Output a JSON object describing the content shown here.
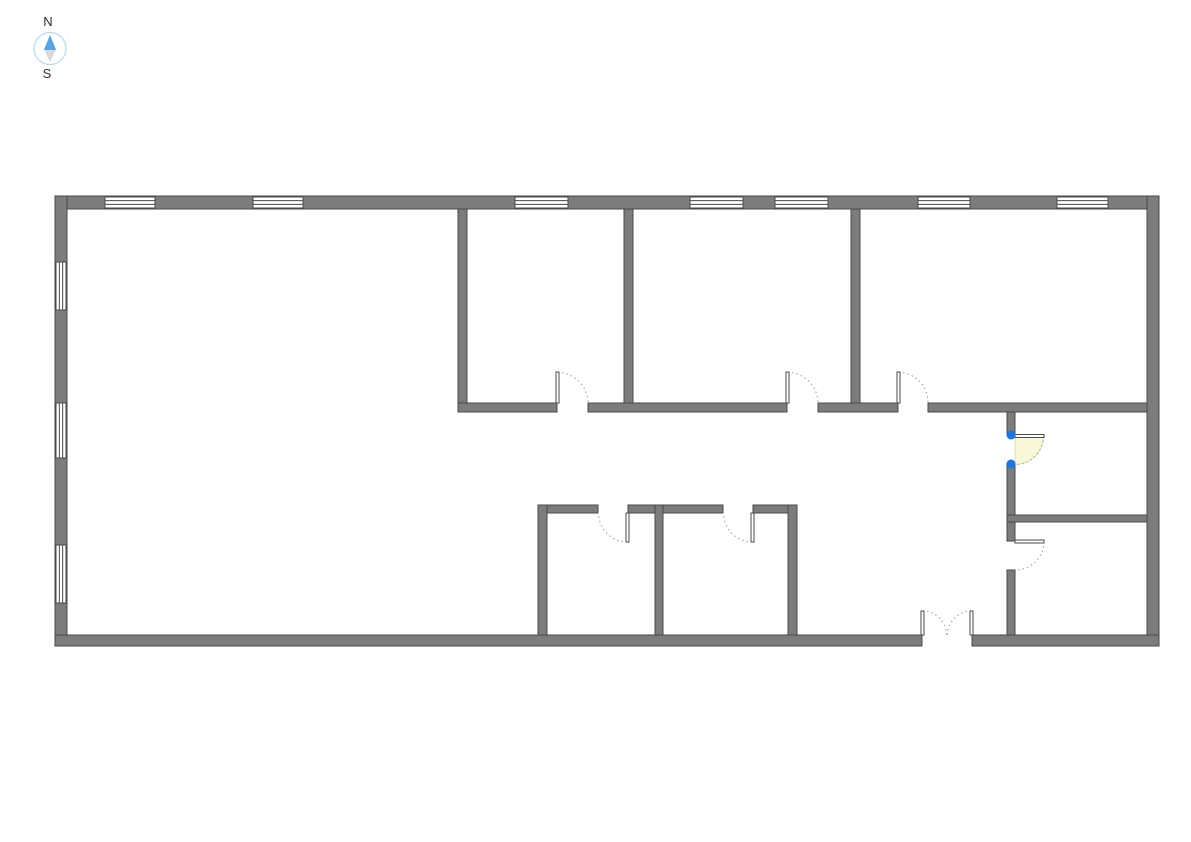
{
  "canvas": {
    "width": 1191,
    "height": 842,
    "background": "#ffffff"
  },
  "compass": {
    "north_label": "N",
    "south_label": "S",
    "ring_color": "#b5d9f2",
    "needle_north_color": "#55a5e5",
    "needle_south_color": "#d8d8d8",
    "label_color": "#2e2e2e"
  },
  "palette": {
    "wall_fill": "#7c7c7c",
    "wall_stroke": "#4a4a4a",
    "window_fill": "#ffffff",
    "window_stroke": "#4a4a4a",
    "door_arc": "#a8a8a8",
    "door_leaf_fill": "#ffffff",
    "door_leaf_stroke": "#4a4a4a",
    "selected_door_fill": "#f8f8d9",
    "selected_door_edge": "#d9d9a6",
    "selection_handle": "#1b76e3"
  },
  "floorplan": {
    "walls": [
      {
        "name": "exterior-wall-north",
        "x": 55,
        "y": 196,
        "w": 1104,
        "h": 13
      },
      {
        "name": "exterior-wall-west",
        "x": 55,
        "y": 196,
        "w": 12,
        "h": 450
      },
      {
        "name": "exterior-wall-east",
        "x": 1147,
        "y": 196,
        "w": 12,
        "h": 450
      },
      {
        "name": "exterior-wall-south-west-segment",
        "x": 55,
        "y": 635,
        "w": 867,
        "h": 11
      },
      {
        "name": "exterior-wall-south-east-segment",
        "x": 972,
        "y": 635,
        "w": 187,
        "h": 11
      },
      {
        "name": "wall-top-rooms-divider-1",
        "x": 458,
        "y": 209,
        "w": 9,
        "h": 194
      },
      {
        "name": "wall-top-rooms-divider-2",
        "x": 624,
        "y": 209,
        "w": 9,
        "h": 194
      },
      {
        "name": "wall-top-rooms-divider-3",
        "x": 851,
        "y": 209,
        "w": 9,
        "h": 194
      },
      {
        "name": "wall-corridor-segment-1",
        "x": 458,
        "y": 403,
        "w": 99,
        "h": 9
      },
      {
        "name": "wall-corridor-segment-2",
        "x": 588,
        "y": 403,
        "w": 199,
        "h": 9
      },
      {
        "name": "wall-corridor-segment-3",
        "x": 818,
        "y": 403,
        "w": 80,
        "h": 9
      },
      {
        "name": "wall-corridor-segment-4",
        "x": 928,
        "y": 403,
        "w": 219,
        "h": 9
      },
      {
        "name": "wall-bottom-rooms-top-segment-1",
        "x": 538,
        "y": 505,
        "w": 60,
        "h": 8
      },
      {
        "name": "wall-bottom-rooms-top-segment-2",
        "x": 628,
        "y": 505,
        "w": 95,
        "h": 8
      },
      {
        "name": "wall-bottom-rooms-top-segment-3",
        "x": 753,
        "y": 505,
        "w": 44,
        "h": 8
      },
      {
        "name": "wall-bottom-rooms-side-left",
        "x": 538,
        "y": 505,
        "w": 9,
        "h": 130
      },
      {
        "name": "wall-bottom-rooms-side-middle",
        "x": 655,
        "y": 505,
        "w": 8,
        "h": 130
      },
      {
        "name": "wall-bottom-rooms-side-right",
        "x": 788,
        "y": 505,
        "w": 9,
        "h": 130
      },
      {
        "name": "wall-right-rooms-vertical-segment-1",
        "x": 1007,
        "y": 412,
        "w": 8,
        "h": 23
      },
      {
        "name": "wall-right-rooms-vertical-segment-2",
        "x": 1007,
        "y": 464,
        "w": 8,
        "h": 77
      },
      {
        "name": "wall-right-rooms-vertical-segment-3",
        "x": 1007,
        "y": 570,
        "w": 8,
        "h": 65
      },
      {
        "name": "wall-right-rooms-horizontal",
        "x": 1007,
        "y": 515,
        "w": 140,
        "h": 7
      }
    ],
    "windows": [
      {
        "name": "window-north-1",
        "orientation": "h",
        "x": 105,
        "y": 197,
        "w": 50,
        "h": 11
      },
      {
        "name": "window-north-2",
        "orientation": "h",
        "x": 253,
        "y": 197,
        "w": 50,
        "h": 11
      },
      {
        "name": "window-north-3",
        "orientation": "h",
        "x": 515,
        "y": 197,
        "w": 53,
        "h": 11
      },
      {
        "name": "window-north-4",
        "orientation": "h",
        "x": 690,
        "y": 197,
        "w": 53,
        "h": 11
      },
      {
        "name": "window-north-5",
        "orientation": "h",
        "x": 775,
        "y": 197,
        "w": 53,
        "h": 11
      },
      {
        "name": "window-north-6",
        "orientation": "h",
        "x": 918,
        "y": 197,
        "w": 52,
        "h": 11
      },
      {
        "name": "window-north-7",
        "orientation": "h",
        "x": 1057,
        "y": 197,
        "w": 51,
        "h": 11
      },
      {
        "name": "window-west-1",
        "orientation": "v",
        "x": 56,
        "y": 262,
        "w": 10,
        "h": 48
      },
      {
        "name": "window-west-2",
        "orientation": "v",
        "x": 56,
        "y": 403,
        "w": 10,
        "h": 55
      },
      {
        "name": "window-west-3",
        "orientation": "v",
        "x": 56,
        "y": 545,
        "w": 10,
        "h": 58
      }
    ],
    "doors": [
      {
        "name": "door-top-room-1",
        "selected": false,
        "leaves": [
          {
            "x": 556,
            "y": 372,
            "w": 3,
            "h": 31
          }
        ],
        "arcs": [
          "M 557.5 372.5 A 30.5 30.5 0 0 1 588 403"
        ],
        "pie": null,
        "handles": []
      },
      {
        "name": "door-top-room-2",
        "selected": false,
        "leaves": [
          {
            "x": 786,
            "y": 372,
            "w": 3,
            "h": 31
          }
        ],
        "arcs": [
          "M 787.5 372.5 A 30.5 30.5 0 0 1 818 403"
        ],
        "pie": null,
        "handles": []
      },
      {
        "name": "door-top-room-3",
        "selected": false,
        "leaves": [
          {
            "x": 897,
            "y": 372,
            "w": 3,
            "h": 31
          }
        ],
        "arcs": [
          "M 898.5 372.5 A 29.5 29.5 0 0 1 928 403"
        ],
        "pie": null,
        "handles": []
      },
      {
        "name": "door-bottom-room-left",
        "selected": false,
        "leaves": [
          {
            "x": 626,
            "y": 513,
            "w": 3,
            "h": 29
          }
        ],
        "arcs": [
          "M 627.5 542 A 29 29 0 0 1 598.5 513"
        ],
        "pie": null,
        "handles": []
      },
      {
        "name": "door-bottom-room-right",
        "selected": false,
        "leaves": [
          {
            "x": 751,
            "y": 513,
            "w": 3,
            "h": 29
          }
        ],
        "arcs": [
          "M 752.5 542 A 29 29 0 0 1 723.5 513"
        ],
        "pie": null,
        "handles": []
      },
      {
        "name": "door-right-room-selected",
        "selected": true,
        "leaves": [
          {
            "x": 1015,
            "y": 434.5,
            "w": 29,
            "h": 3
          }
        ],
        "arcs": [
          "M 1043.5 436 A 28.5 28.5 0 0 1 1015 464.5"
        ],
        "pie": "M 1015 436 L 1043.5 436 A 28.5 28.5 0 0 1 1015 464.5 Z",
        "handles": [
          {
            "cx": 1011,
            "cy": 435
          },
          {
            "cx": 1011,
            "cy": 464
          }
        ]
      },
      {
        "name": "door-right-room-lower",
        "selected": false,
        "leaves": [
          {
            "x": 1015,
            "y": 540,
            "w": 29,
            "h": 3
          }
        ],
        "arcs": [
          "M 1044 541.5 A 28.5 28.5 0 0 1 1015.5 570"
        ],
        "pie": null,
        "handles": []
      },
      {
        "name": "double-door-south",
        "selected": false,
        "leaves": [
          {
            "x": 921,
            "y": 611,
            "w": 3,
            "h": 24
          },
          {
            "x": 970,
            "y": 611,
            "w": 3,
            "h": 24
          }
        ],
        "arcs": [
          "M 922.5 611 A 24 24 0 0 1 946.5 635",
          "M 971.5 611 A 24 24 0 0 0 947.5 635"
        ],
        "pie": null,
        "handles": []
      }
    ]
  }
}
